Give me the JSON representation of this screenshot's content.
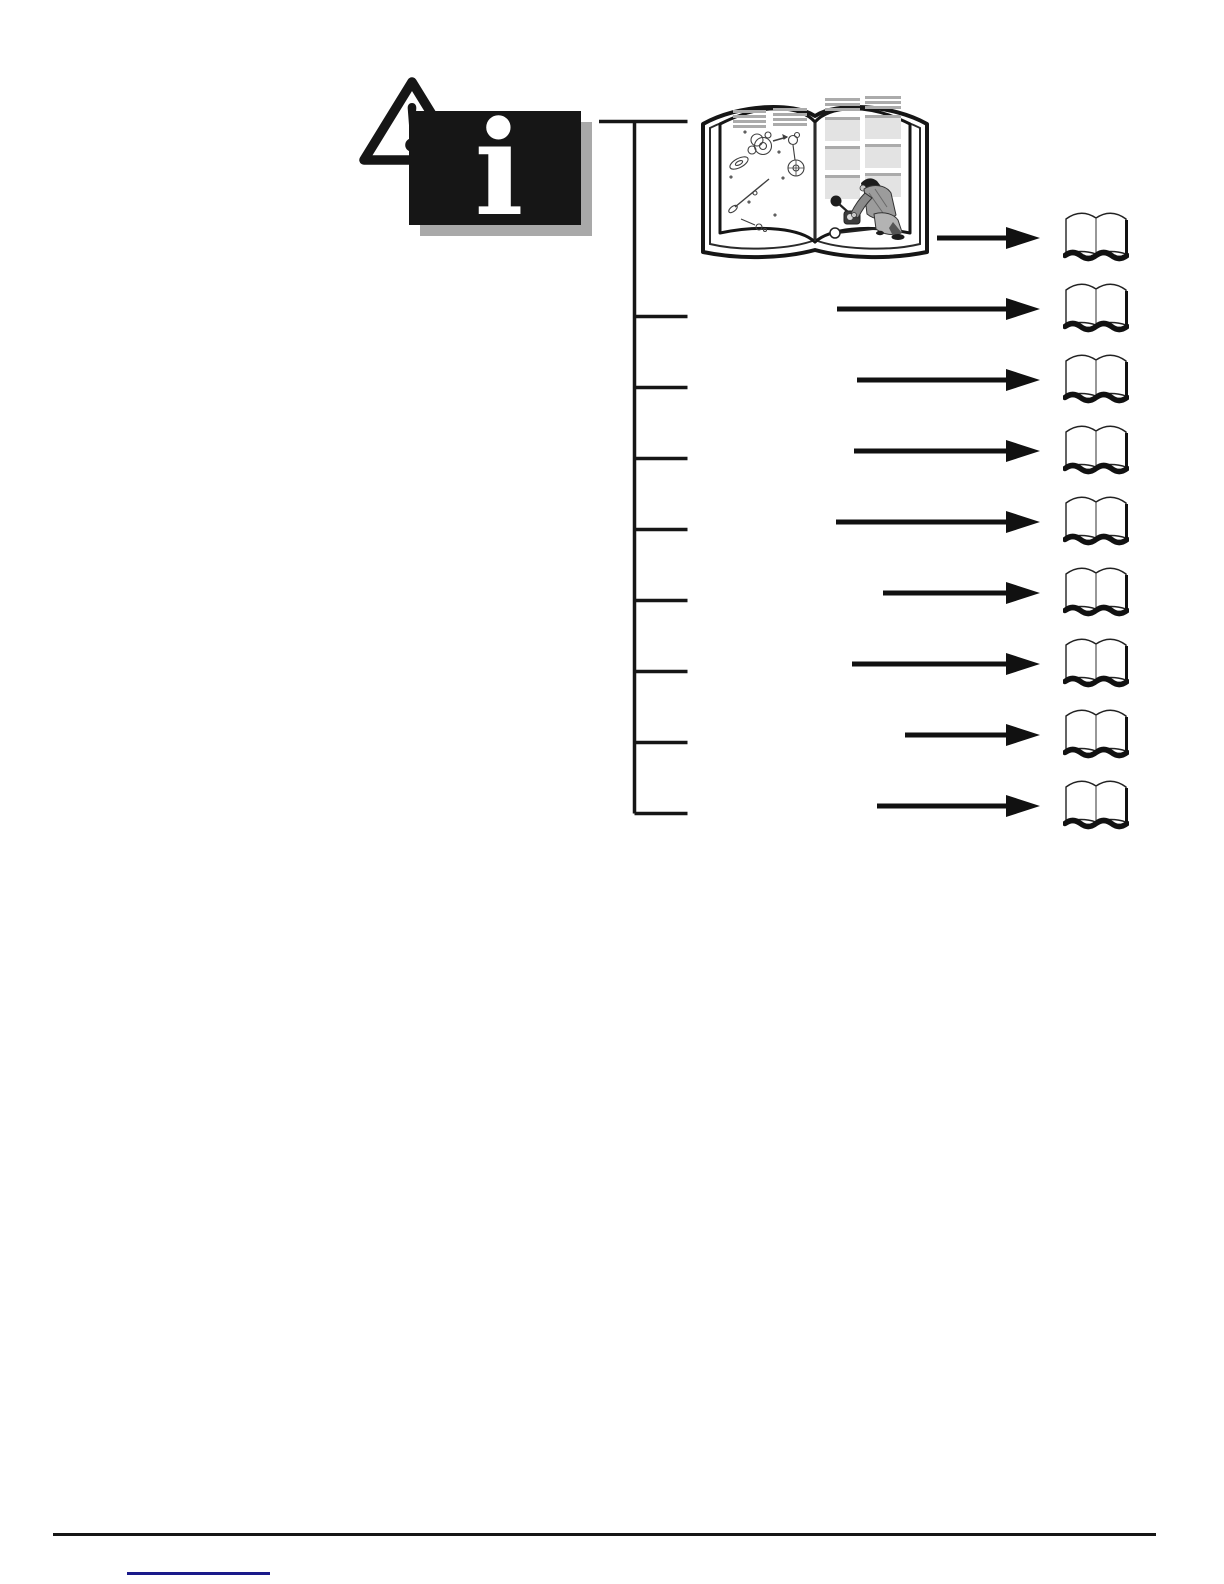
{
  "palette": {
    "ink": "#161616",
    "paper": "#ffffff",
    "box_shadow_gray": "#a9a9a9",
    "page_placeholder_gray": "#e3e3e3",
    "placeholder_bar_gray": "#ababab",
    "link_blue": "#1a1a8a"
  },
  "legend": {
    "warning_icon": "warning-triangle-icon",
    "info_icon": "info-box-icon",
    "info_glyph": "i"
  },
  "map": {
    "root_icon": "open-service-manual-illustration",
    "rows": [
      {
        "icon": "open-book-icon",
        "arrow": "right-arrow-icon"
      },
      {
        "icon": "open-book-icon",
        "arrow": "right-arrow-icon"
      },
      {
        "icon": "open-book-icon",
        "arrow": "right-arrow-icon"
      },
      {
        "icon": "open-book-icon",
        "arrow": "right-arrow-icon"
      },
      {
        "icon": "open-book-icon",
        "arrow": "right-arrow-icon"
      },
      {
        "icon": "open-book-icon",
        "arrow": "right-arrow-icon"
      },
      {
        "icon": "open-book-icon",
        "arrow": "right-arrow-icon"
      },
      {
        "icon": "open-book-icon",
        "arrow": "right-arrow-icon"
      },
      {
        "icon": "open-book-icon",
        "arrow": "right-arrow-icon"
      }
    ]
  },
  "footer": {
    "has_divider": true,
    "link_underline_only": true,
    "link_text": ""
  }
}
